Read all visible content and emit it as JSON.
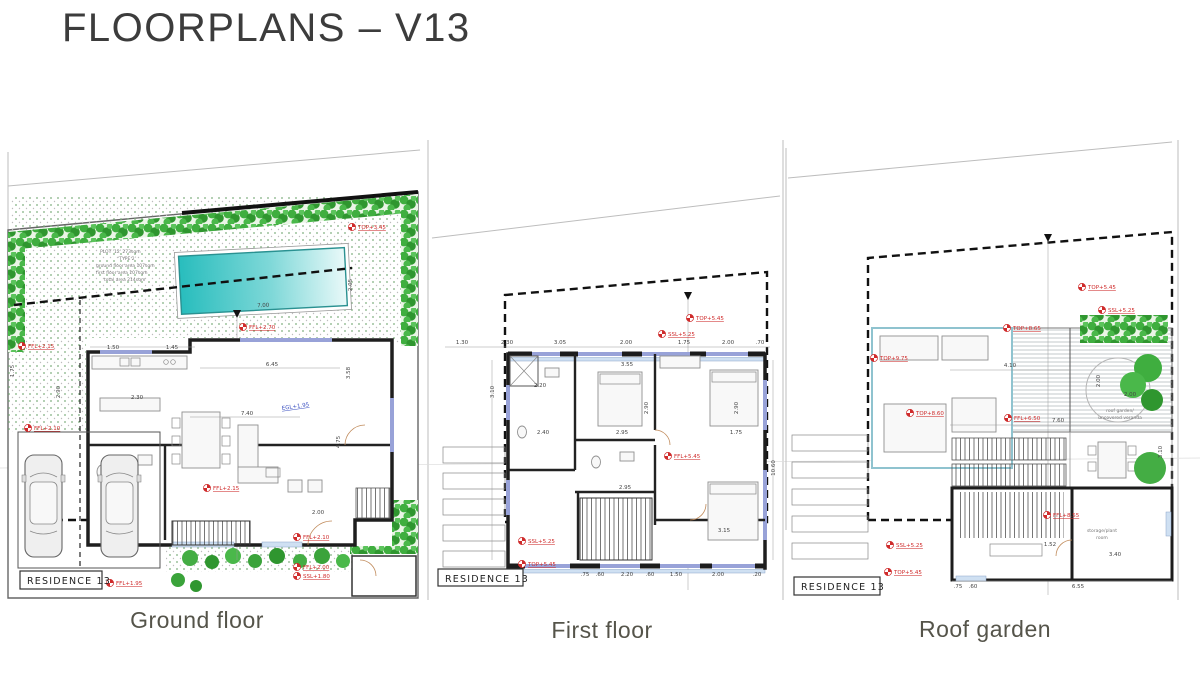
{
  "title": "FLOORPLANS – V13",
  "colors": {
    "marker_red": "#cf2b2b",
    "pool_teal": "#2bbcbc",
    "hedge_green": "#3aa33a",
    "window_purple": "#98a2d8",
    "sill_blue": "#cfe0f2",
    "blue_annotation": "#3a4fc0"
  },
  "plans": [
    {
      "caption": "Ground floor",
      "residence_label": "RESIDENCE 13",
      "plot_info": [
        "PLOT '12' 273sqm",
        "'TYPE 2'",
        "ground floor area 107sqm",
        "first floor area 107sqm",
        "total area 214sqm"
      ],
      "annotations": [
        "TOP+3.45",
        "FFL+2.15",
        "FFL+2.10",
        "FFL+2.70",
        "FFL+2.15",
        "FFL+1.95",
        "FFL+2.10",
        "FFL+2.00",
        "SSL+1.80"
      ],
      "blue_annotation": "EGL+1.95",
      "dims": [
        "7.00",
        "1.50",
        "1.45",
        "2.30",
        "6.45",
        "7.40",
        "2.00",
        "4.75",
        "2.90",
        "1.75",
        "3.58",
        "2.05"
      ]
    },
    {
      "caption": "First floor",
      "residence_label": "RESIDENCE 13",
      "annotations": [
        "TOP+5.45",
        "SSL+5.25",
        "FFL+5.45",
        "SSL+5.25",
        "TOP+5.45"
      ],
      "dims_top": [
        "1.30",
        "2.30",
        "3.05",
        "2.00",
        "1.75",
        "2.00",
        ".70"
      ],
      "dims": [
        "3.55",
        "2.20",
        "2.40",
        "2.95",
        "1.75",
        "2.90",
        "2.90",
        "2.95",
        "3.15",
        "3.10"
      ],
      "dims_bottom": [
        ".75",
        ".60",
        "2.20",
        ".60",
        "1.50",
        "2.00",
        ".20"
      ],
      "dim_right": "10.60"
    },
    {
      "caption": "Roof garden",
      "residence_label": "RESIDENCE 13",
      "annotations": [
        "TOP+5.45",
        "SSL+5.25",
        "TOP+8.65",
        "TOP+9.75",
        "TOP+8.60",
        "FFL+6.50",
        "FFL+8.55",
        "SSL+5.25",
        "TOP+5.45"
      ],
      "dims": [
        "4.10",
        "2.00",
        "2.00",
        "7.60",
        "1.52",
        "3.40",
        "6.55",
        ".75",
        ".60",
        "3.10"
      ],
      "room_labels": [
        "roof garden/",
        "uncovered veranda",
        "storage/plant",
        "room"
      ]
    }
  ]
}
